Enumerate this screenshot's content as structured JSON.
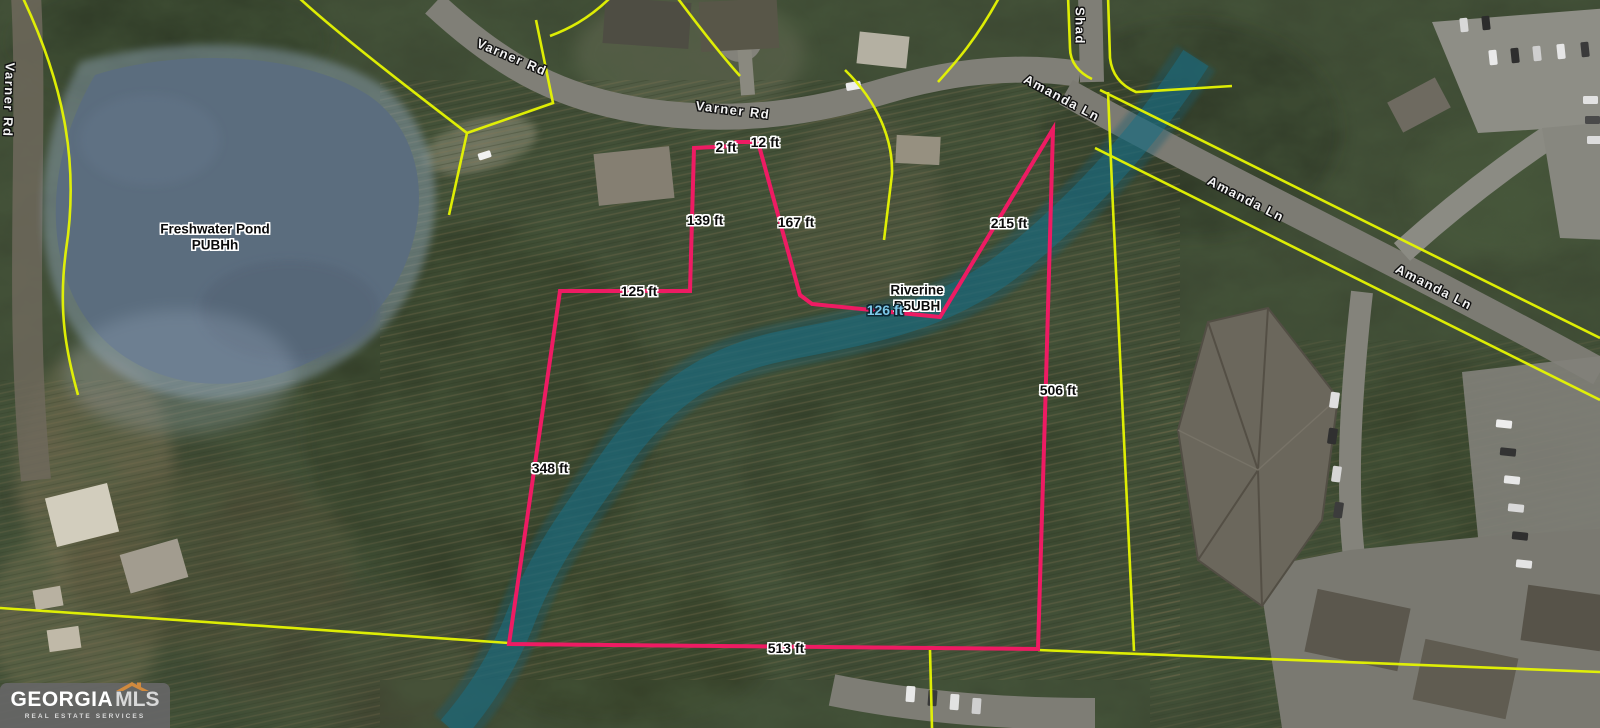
{
  "map": {
    "road_labels": [
      {
        "id": "varner-rd-left-edge",
        "text": "Varner Rd"
      },
      {
        "id": "varner-rd-upper",
        "text": "Varner Rd"
      },
      {
        "id": "varner-rd-lower",
        "text": "Varner Rd"
      },
      {
        "id": "shady-road-partial",
        "text": "Shad"
      },
      {
        "id": "amanda-ln-upper",
        "text": "Amanda Ln"
      },
      {
        "id": "amanda-ln-middle",
        "text": "Amanda Ln"
      },
      {
        "id": "amanda-ln-lower",
        "text": "Amanda Ln"
      }
    ],
    "wetlands": {
      "pond_name": "Freshwater Pond",
      "pond_code": "PUBHh",
      "stream_name": "Riverine",
      "stream_code": "R5UBH",
      "stream_width_label": "126 ft"
    },
    "boundary_measurements": [
      {
        "side": "top-jog-a",
        "text": "2 ft"
      },
      {
        "side": "top-jog-b",
        "text": "12 ft"
      },
      {
        "side": "upper-left",
        "text": "139 ft"
      },
      {
        "side": "upper-right",
        "text": "167 ft"
      },
      {
        "side": "northeast",
        "text": "215 ft"
      },
      {
        "side": "west-upper",
        "text": "125 ft"
      },
      {
        "side": "west",
        "text": "348 ft"
      },
      {
        "side": "east",
        "text": "506 ft"
      },
      {
        "side": "south",
        "text": "513 ft"
      }
    ],
    "colors": {
      "boundary_pink": "#ee1b63",
      "parcel_yellow": "#e6f602",
      "wetland_overlay_blue": "#9db4cf",
      "stream_teal": "#1e6e86",
      "stream_width_text": "#7cc7e8"
    }
  },
  "logo": {
    "brand_primary": "GEORGIA",
    "brand_secondary": "MLS",
    "tagline": "REAL ESTATE SERVICES",
    "roof_color": "#d08a3e"
  }
}
